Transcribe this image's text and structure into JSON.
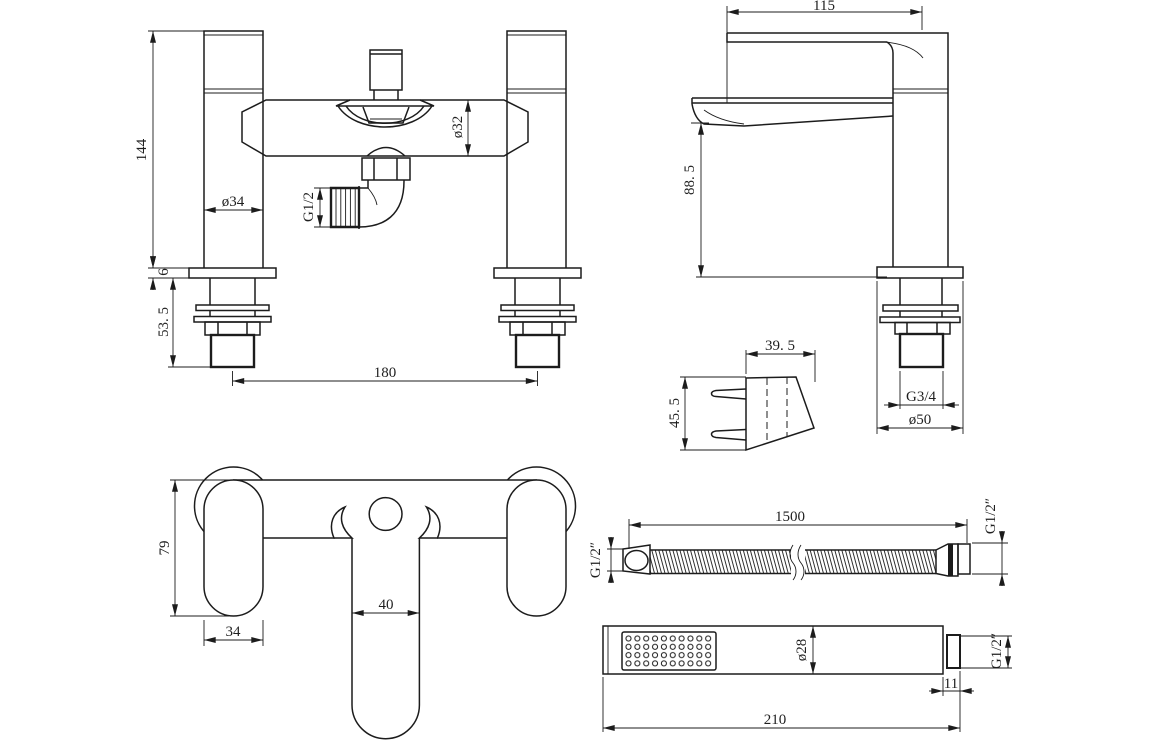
{
  "meta": {
    "background": "#ffffff",
    "line_color": "#1c1c1c",
    "drawing_type": "technical dimension drawing"
  },
  "dims": {
    "front": {
      "height": "144",
      "pillar_dia": "ø34",
      "outlet_thread": "G1/2",
      "body_dia": "ø32",
      "deck_thk": "6",
      "shank_len": "53. 5",
      "centres": "180"
    },
    "side": {
      "reach": "115",
      "height": "88. 5",
      "thread": "G3/4",
      "flange": "ø50"
    },
    "bracket": {
      "width": "39. 5",
      "height": "45. 5"
    },
    "top": {
      "depth": "79",
      "handle": "34",
      "spout": "40"
    },
    "hose": {
      "length": "1500",
      "thread_left": "G1/2″",
      "thread_right": "G1/2″"
    },
    "handset": {
      "dia": "ø28",
      "nipple": "11",
      "thread": "G1/2″",
      "length": "210"
    }
  }
}
